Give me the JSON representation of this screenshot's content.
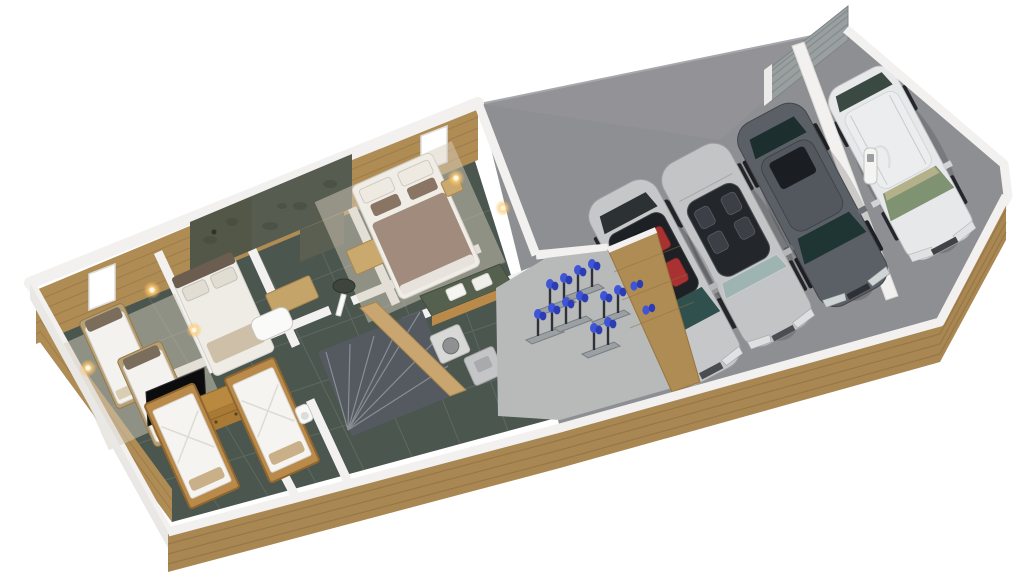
{
  "scene": {
    "type": "isometric-3d-floor-plan-render",
    "description": "3D cutaway floor plan of a chalet lower floor with bedrooms, bathrooms, ski boot room and four-car garage",
    "background_color": "#ffffff"
  },
  "house": {
    "floor_color": "#4b564f",
    "grout_color": "#66716a",
    "wall_color": "#f2f1ef",
    "brick_color": "#b08c55",
    "stone_color": "#575c50",
    "rug_color": "#d6cdbd",
    "carpet_color": "#b7bab9",
    "window_count": 4,
    "wall_lamp_count": 5,
    "rooms": [
      {
        "name": "bedroom-left",
        "label": "Twin bedroom",
        "furniture": [
          "single-bed",
          "single-bed",
          "wall-lamp",
          "rug"
        ]
      },
      {
        "name": "bedroom-middle",
        "label": "Double bedroom",
        "furniture": [
          "double-bed",
          "wall-lamp"
        ]
      },
      {
        "name": "shower-room",
        "label": "Stone shower room",
        "furniture": [
          "walk-in-shower",
          "stone-wall",
          "vanity-unit"
        ]
      },
      {
        "name": "bathroom",
        "label": "Stone bathroom",
        "furniture": [
          "bathtub",
          "stone-sink",
          "vanity-unit",
          "stone-wall"
        ]
      },
      {
        "name": "master-bedroom",
        "label": "Master bedroom",
        "furniture": [
          "double-bed",
          "nightstand",
          "bedside-lamp",
          "window-seat-bench",
          "cushions"
        ]
      },
      {
        "name": "bunk-room",
        "label": "Kids twin bedroom",
        "furniture": [
          "timber-single-bed",
          "timber-single-bed",
          "dresser",
          "tv",
          "plant"
        ]
      },
      {
        "name": "hallway",
        "label": "Hallway",
        "furniture": [
          "open-doors"
        ]
      },
      {
        "name": "wc",
        "label": "WC",
        "furniture": [
          "toilet"
        ]
      },
      {
        "name": "staircase",
        "label": "Winder staircase",
        "furniture": [
          "dark-stairs",
          "timber-balustrade"
        ]
      },
      {
        "name": "laundry",
        "label": "Laundry corner",
        "furniture": [
          "washing-machine",
          "tumble-dryer"
        ]
      },
      {
        "name": "boot-room",
        "label": "Ski boot room",
        "furniture": [
          "boot-dryer-stand",
          "boot-dryer-stand",
          "boot-dryer-stand",
          "boot-dryer-stand",
          "boot-dryer-stand",
          "boot-dryer-stand",
          "blue-ski-boots"
        ]
      }
    ],
    "tv": {
      "brand_label": "NETFLIX",
      "screen_color": "#0c0c0e",
      "logo_color": "#e50914"
    }
  },
  "garage": {
    "floor_color": "#8e8f93",
    "door_color": "#99a09f",
    "door_type": "corrugated sectional garage door",
    "cars": [
      {
        "id": "car-1",
        "name": "silver sedan with panoramic glass roof and red interior",
        "body_color": "#c6c7c9",
        "interior_color": "#a83232"
      },
      {
        "id": "car-2",
        "name": "silver convertible with top down",
        "body_color": "#c3c4c6"
      },
      {
        "id": "car-3",
        "name": "dark grey SUV coupe",
        "body_color": "#5b5f66"
      },
      {
        "id": "car-4",
        "name": "white compact SUV on charge",
        "body_color": "#e7e8ea"
      }
    ],
    "ev_charger": {
      "label": "EV charging post",
      "color": "#f4f4f2"
    }
  },
  "exterior": {
    "wall_band_color": "#a98753",
    "trim_color": "#f2f1ef",
    "background_color": "#ffffff"
  }
}
